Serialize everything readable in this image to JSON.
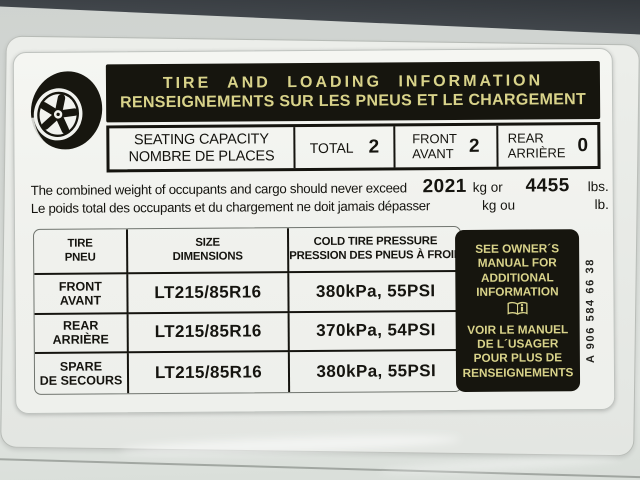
{
  "label": {
    "header": {
      "title_en": "TIRE AND LOADING INFORMATION",
      "title_fr": "RENSEIGNEMENTS SUR LES PNEUS ET LE CHARGEMENT"
    },
    "seating": {
      "label_en": "SEATING CAPACITY",
      "label_fr": "NOMBRE DE PLACES",
      "total_label": "TOTAL",
      "total_value": "2",
      "front_label_en": "FRONT",
      "front_label_fr": "AVANT",
      "front_value": "2",
      "rear_label_en": "REAR",
      "rear_label_fr": "ARRIÈRE",
      "rear_value": "0"
    },
    "weight": {
      "line_en": "The combined weight of occupants and cargo should never exceed",
      "line_fr": "Le poids total des occupants et du chargement ne doit jamais dépasser",
      "value_kg": "2021",
      "unit_kg_en": "kg or",
      "unit_kg_fr": "kg ou",
      "value_lbs": "4455",
      "unit_lbs_en": "lbs.",
      "unit_lbs_fr": "lb."
    },
    "tire_table": {
      "headers": [
        {
          "en": "TIRE",
          "fr": "PNEU"
        },
        {
          "en": "SIZE",
          "fr": "DIMENSIONS"
        },
        {
          "en": "COLD TIRE PRESSURE",
          "fr": "PRESSION DES PNEUS À FROID"
        }
      ],
      "rows": [
        {
          "tire_en": "FRONT",
          "tire_fr": "AVANT",
          "size": "LT215/85R16",
          "pressure": "380kPa, 55PSI"
        },
        {
          "tire_en": "REAR",
          "tire_fr": "ARRIÈRE",
          "size": "LT215/85R16",
          "pressure": "370kPa, 54PSI"
        },
        {
          "tire_en": "SPARE",
          "tire_fr": "DE SECOURS",
          "size": "LT215/85R16",
          "pressure": "380kPa, 55PSI"
        }
      ]
    },
    "info_box": {
      "text_en": "SEE OWNER´S MANUAL FOR ADDITIONAL INFORMATION",
      "text_fr": "VOIR LE MANUEL DE L´USAGER POUR PLUS DE RENSEIGNEMENTS",
      "icon": "open-book-info-icon"
    },
    "part_number": "A 906 584 66 38",
    "icons": {
      "top_left": "tire-wheel-icon"
    }
  },
  "colors": {
    "band_background": "#16150e",
    "band_text_yellow": "#d9d38a",
    "sticker_white": "#f2f3ef",
    "ink_black": "#15140f",
    "panel_gray": "#d4d8d4",
    "door_trim_dark": "#3c4146"
  }
}
